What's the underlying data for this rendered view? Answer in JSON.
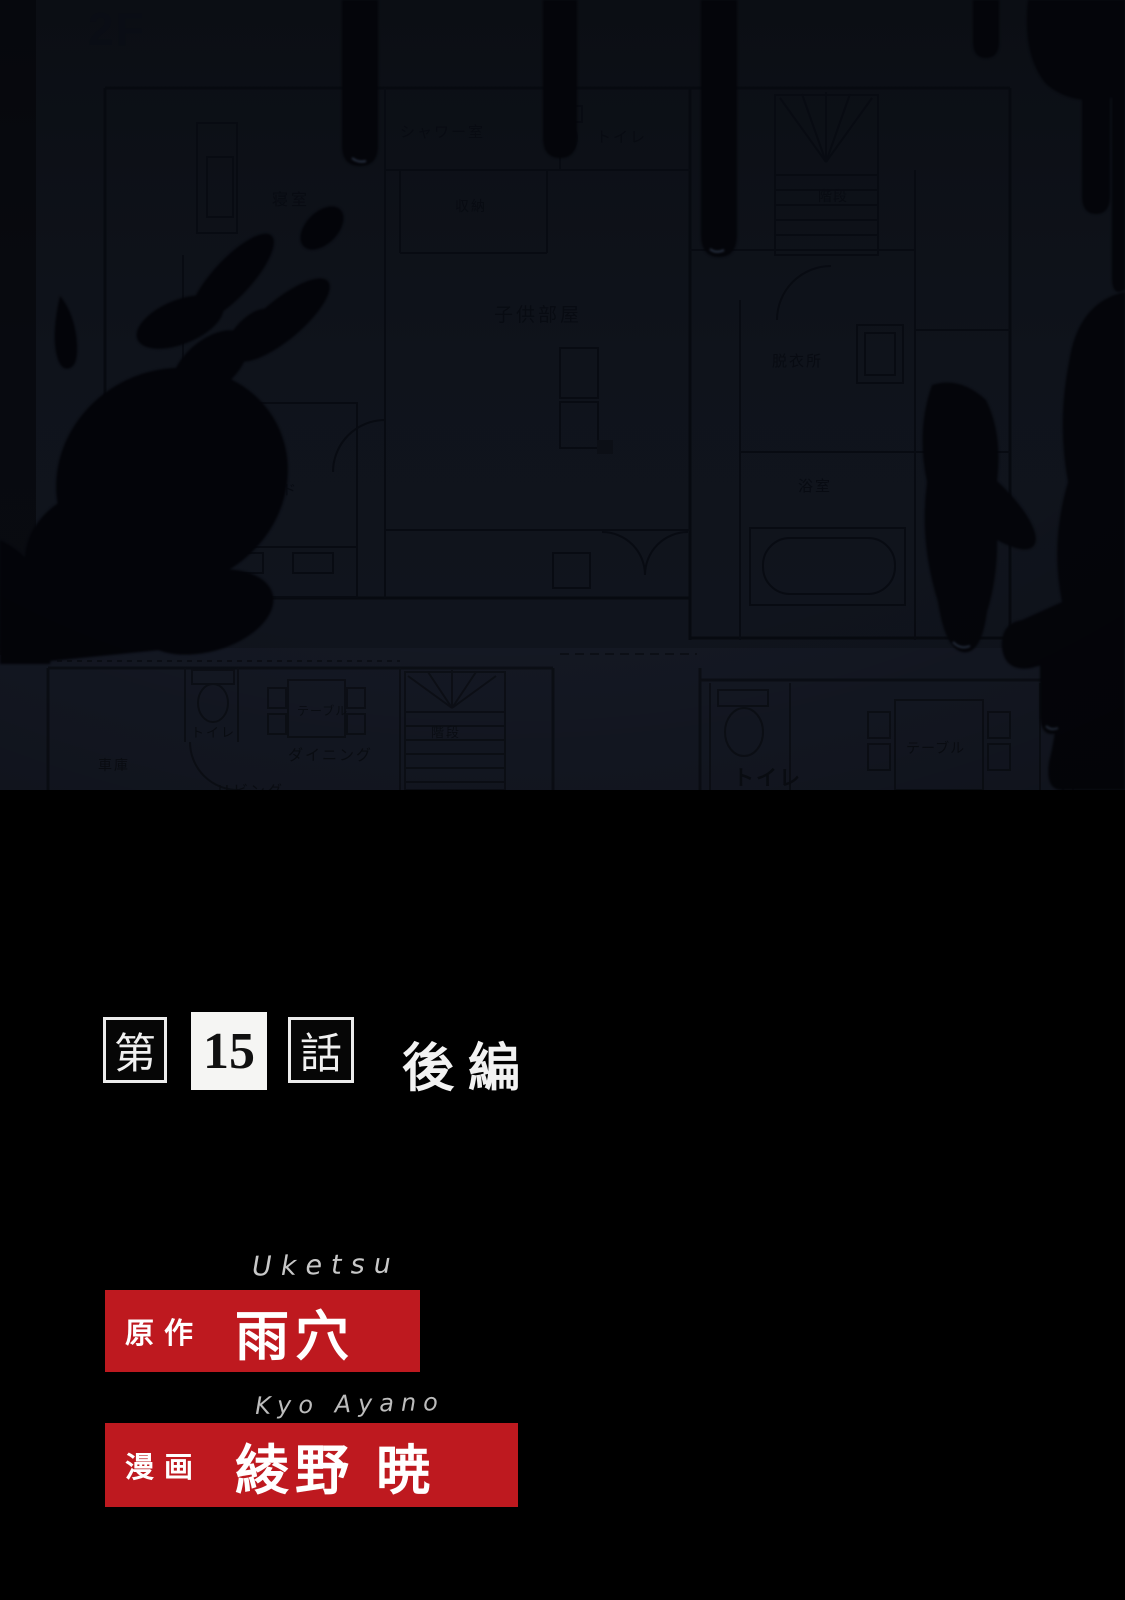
{
  "plan2f": {
    "floor_label": "2F",
    "shower_room": "シャワー室",
    "toilet": "トイレ",
    "storage": "収納",
    "bedroom": "寝室",
    "kids_room": "子供部屋",
    "stairs": "階段",
    "dressing_room": "脱衣所",
    "bathroom": "浴室",
    "bed": "ベッド",
    "balcony": "バルコニー"
  },
  "plan1f": {
    "garage": "車庫",
    "toilet_left": "トイレ",
    "table_left": "テーブル",
    "dining": "ダイニング",
    "living": "リビング",
    "stairs": "階段",
    "toilet_right": "トイレ",
    "table_right": "テーブル"
  },
  "title": {
    "chapter_prefix": "第",
    "chapter_number": "15",
    "chapter_suffix": "話",
    "part_label": "後編"
  },
  "credits": {
    "author_romaji": "Uketsu",
    "author_role": "原作",
    "author_name": "雨穴",
    "artist_romaji": "Kyo Ayano",
    "artist_role": "漫画",
    "artist_name": "綾野 暁"
  },
  "colors": {
    "credit_red": "#be191f",
    "plan_paper": "#10141d",
    "blood_black": "#04050a"
  }
}
